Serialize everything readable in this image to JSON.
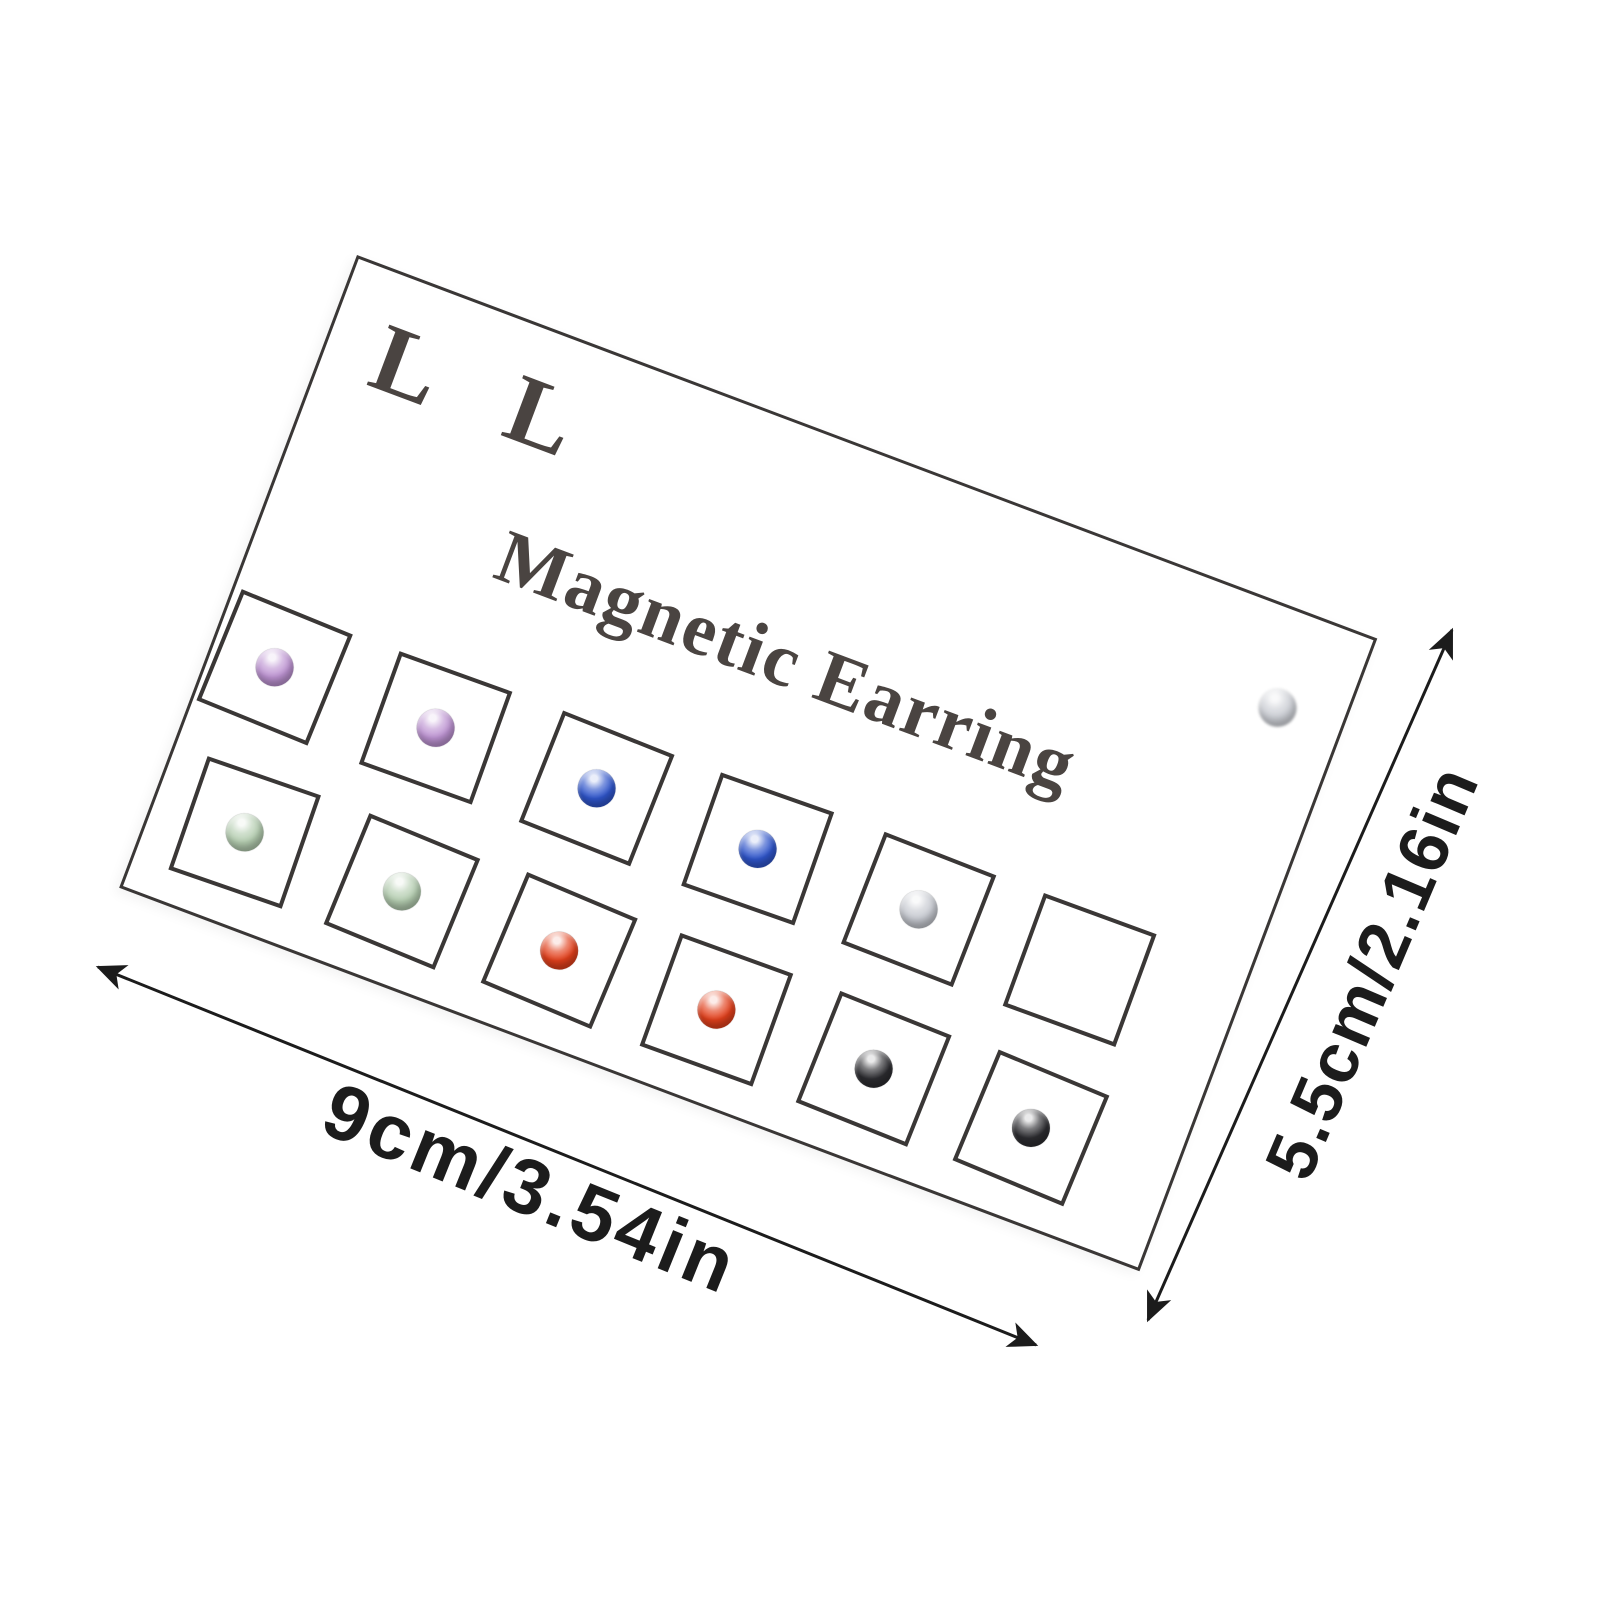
{
  "card": {
    "brand": "L L",
    "title": "Magnetic Earring"
  },
  "grid": {
    "rows": 2,
    "cols": 6,
    "cells": [
      {
        "stud": "purple"
      },
      {
        "stud": "purple"
      },
      {
        "stud": "blue"
      },
      {
        "stud": "blue"
      },
      {
        "stud": "silver"
      },
      {
        "stud": "empty"
      },
      {
        "stud": "green"
      },
      {
        "stud": "green"
      },
      {
        "stud": "red"
      },
      {
        "stud": "red"
      },
      {
        "stud": "black"
      },
      {
        "stud": "black"
      }
    ]
  },
  "loose_stud": {
    "stud": "silver"
  },
  "dimensions": {
    "width_label": "9cm/3.54in",
    "height_label": "5.5cm/2.16in"
  },
  "colors": {
    "page-bg": "#ffffff",
    "card-line": "#3a3736",
    "card-text": "#4a4441",
    "arrow": "#1c1c1c",
    "label-text": "#1c1c1c",
    "stud-purple": "#bd93d2",
    "stud-blue": "#2f55cb",
    "stud-green": "#b4cdb0",
    "stud-red": "#e2401c",
    "stud-silver": "#c6c9d0",
    "stud-black": "#2c2c30"
  }
}
